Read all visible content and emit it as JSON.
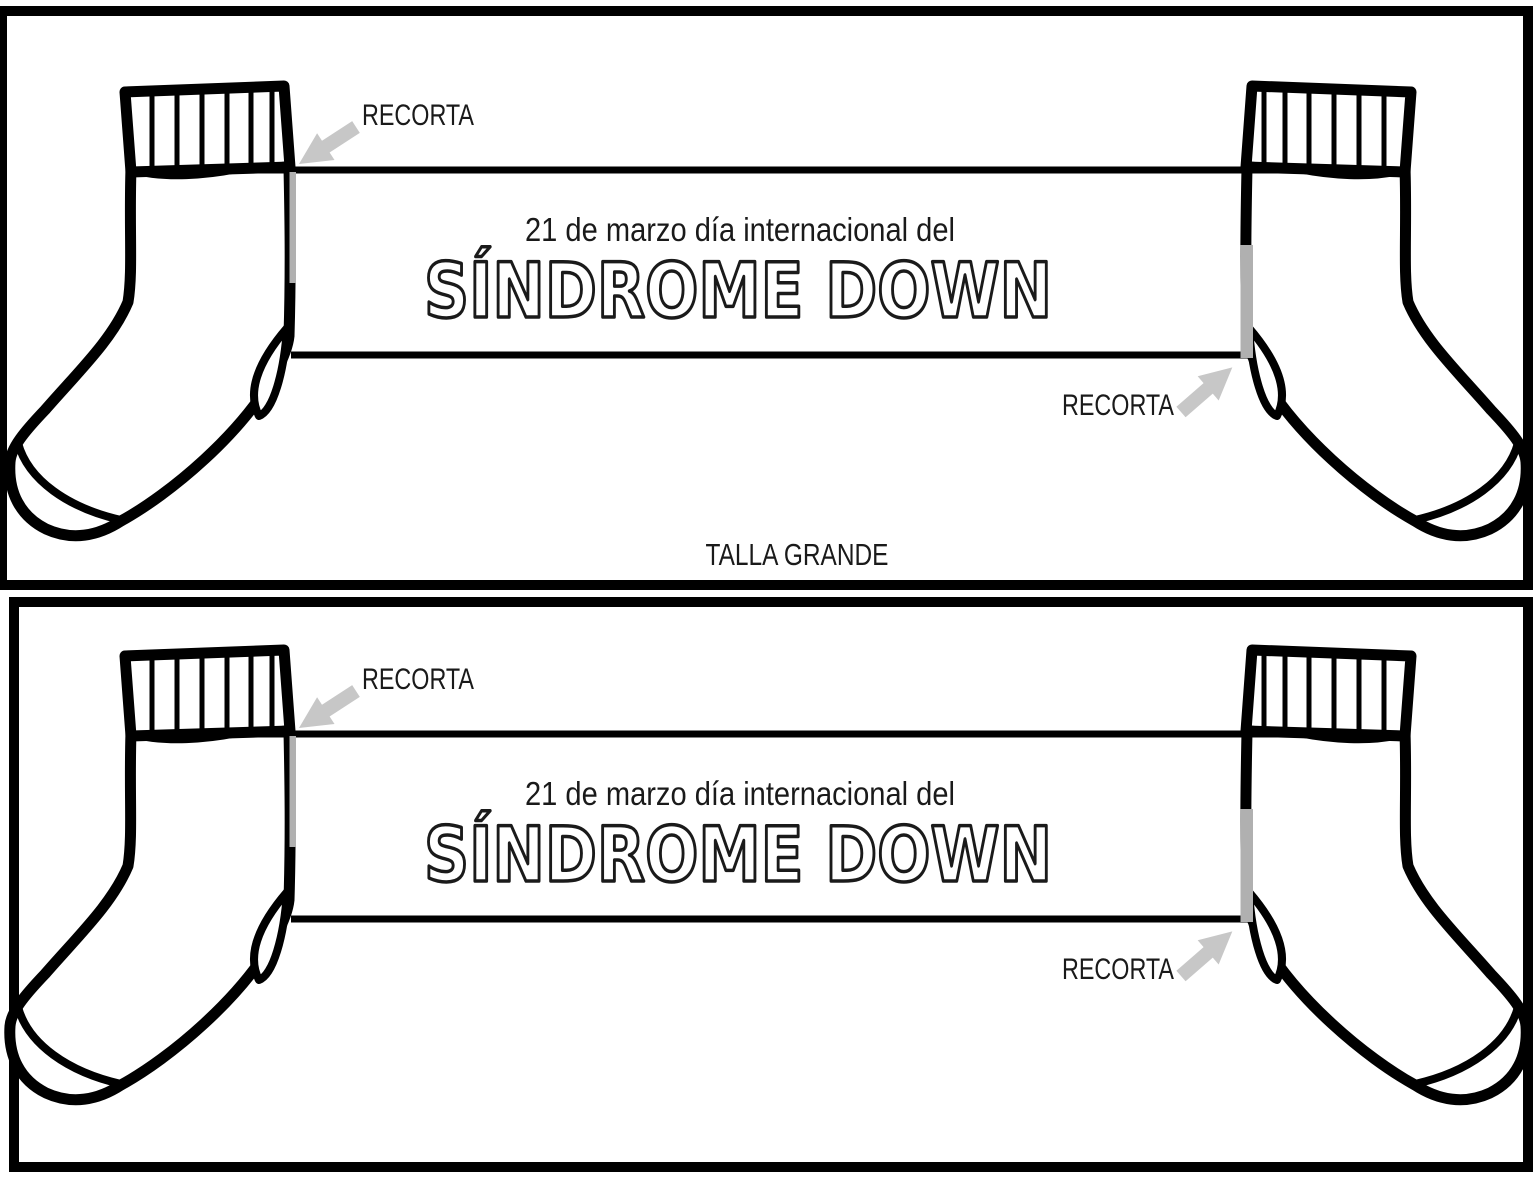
{
  "page": {
    "background": "#ffffff"
  },
  "colors": {
    "ink": "#000000",
    "text": "#1a1a1a",
    "arrow_gray": "#c7c7c7",
    "cut_mark_gray": "#b0b0b0"
  },
  "panels": [
    {
      "header_line": "21 de marzo día internacional del",
      "title": "SÍNDROME DOWN",
      "cut_label_top_left": "RECORTA",
      "cut_label_bottom_right": "RECORTA",
      "size_label": "TALLA GRANDE"
    },
    {
      "header_line": "21 de marzo día internacional del",
      "title": "SÍNDROME DOWN",
      "cut_label_top_left": "RECORTA",
      "cut_label_bottom_right": "RECORTA"
    }
  ]
}
